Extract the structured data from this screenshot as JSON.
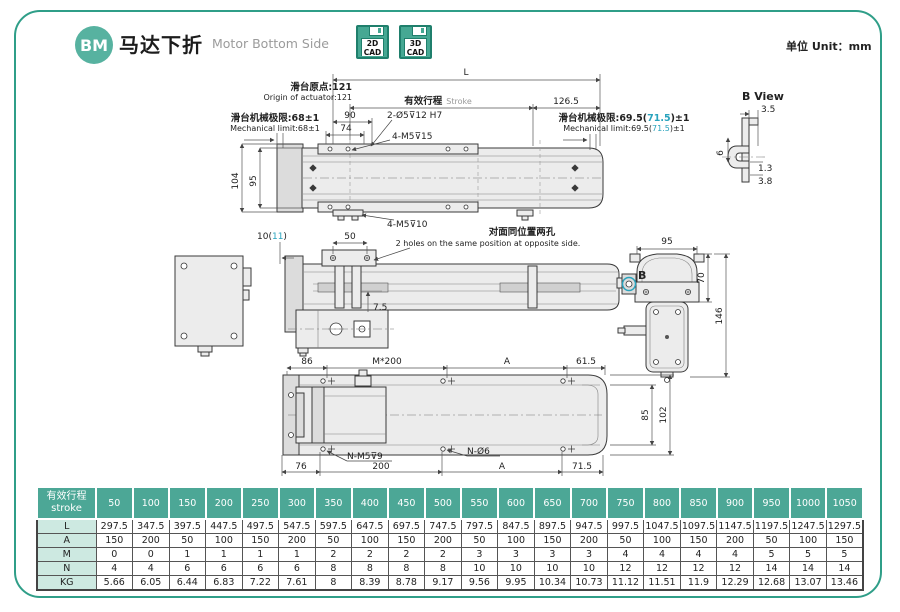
{
  "accent": "#29a3bd",
  "header": {
    "badge": "BM",
    "title_zh": "马达下折",
    "title_en": "Motor Bottom Side",
    "cad": [
      {
        "top": "2D",
        "bottom": "CAD"
      },
      {
        "top": "3D",
        "bottom": "CAD"
      }
    ],
    "unit": "单位 Unit：mm"
  },
  "drawing": {
    "top_view": {
      "L": "L",
      "origin_zh": "滑台原点:121",
      "origin_en": "Origin of actuator:121",
      "stroke_zh": "有效行程",
      "stroke_en": "Stroke",
      "end_len": "126.5",
      "limit_left_zh": "滑台机械极限:68±1",
      "limit_left_en": "Mechanical limit:68±1",
      "dim90": "90",
      "dim74": "74",
      "holes": "2-Ø5⊽12 H7",
      "taps_top": "4-M5⊽15",
      "limit_right_zh": [
        "滑台机械极限:69.5(",
        "71.5",
        ")±1"
      ],
      "limit_right_en": [
        "Mechanical limit:69.5(",
        "71.5",
        ")±1"
      ],
      "h104": "104",
      "h95": "95"
    },
    "b_view": {
      "title": "B View",
      "d35": "3.5",
      "d6": "6",
      "d13": "1.3",
      "d38": "3.8"
    },
    "side_view": {
      "offset": [
        "10(",
        "11",
        ")"
      ],
      "dim50": "50",
      "taps_bottom": "4-M5⊽10",
      "holes_zh": "对面同位置两孔",
      "holes_en": "2 holes on the same position at opposite side.",
      "dim75": "7.5"
    },
    "cross_view": {
      "w95": "95",
      "h70": "70",
      "h146": "146",
      "b_label": "B"
    },
    "bottom_view": {
      "d86": "86",
      "pitch": "M*200",
      "dimA_top": "A",
      "d615": "61.5",
      "taps": "N-M5⊽9",
      "holes": "N-Ø6",
      "d76": "76",
      "d200": "200",
      "dimA_bottom": "A",
      "d715": "71.5",
      "h85": "85",
      "h102": "102"
    }
  },
  "table": {
    "header_zh": "有效行程",
    "header_en": "stroke",
    "strokes": [
      "50",
      "100",
      "150",
      "200",
      "250",
      "300",
      "350",
      "400",
      "450",
      "500",
      "550",
      "600",
      "650",
      "700",
      "750",
      "800",
      "850",
      "900",
      "950",
      "1000",
      "1050"
    ],
    "rows": [
      {
        "label": "L",
        "values": [
          "297.5",
          "347.5",
          "397.5",
          "447.5",
          "497.5",
          "547.5",
          "597.5",
          "647.5",
          "697.5",
          "747.5",
          "797.5",
          "847.5",
          "897.5",
          "947.5",
          "997.5",
          "1047.5",
          "1097.5",
          "1147.5",
          "1197.5",
          "1247.5",
          "1297.5"
        ]
      },
      {
        "label": "A",
        "values": [
          "150",
          "200",
          "50",
          "100",
          "150",
          "200",
          "50",
          "100",
          "150",
          "200",
          "50",
          "100",
          "150",
          "200",
          "50",
          "100",
          "150",
          "200",
          "50",
          "100",
          "150"
        ]
      },
      {
        "label": "M",
        "values": [
          "0",
          "0",
          "1",
          "1",
          "1",
          "1",
          "2",
          "2",
          "2",
          "2",
          "3",
          "3",
          "3",
          "3",
          "4",
          "4",
          "4",
          "4",
          "5",
          "5",
          "5"
        ]
      },
      {
        "label": "N",
        "values": [
          "4",
          "4",
          "6",
          "6",
          "6",
          "6",
          "8",
          "8",
          "8",
          "8",
          "10",
          "10",
          "10",
          "10",
          "12",
          "12",
          "12",
          "12",
          "14",
          "14",
          "14"
        ]
      },
      {
        "label": "KG",
        "values": [
          "5.66",
          "6.05",
          "6.44",
          "6.83",
          "7.22",
          "7.61",
          "8",
          "8.39",
          "8.78",
          "9.17",
          "9.56",
          "9.95",
          "10.34",
          "10.73",
          "11.12",
          "11.51",
          "11.9",
          "12.29",
          "12.68",
          "13.07",
          "13.46"
        ]
      }
    ]
  }
}
